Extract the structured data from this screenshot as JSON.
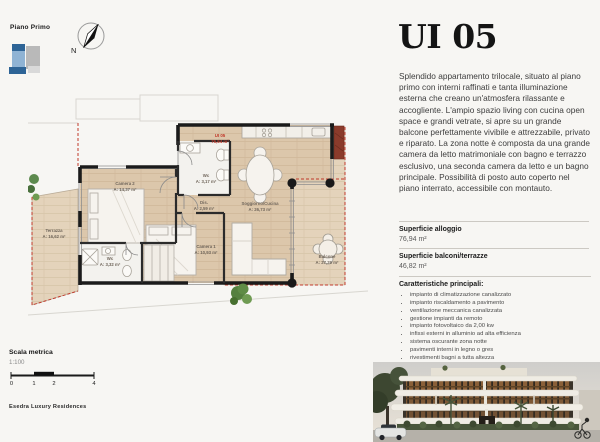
{
  "header": {
    "floor_label": "Piano Primo"
  },
  "compass": {
    "label": "N"
  },
  "unit": {
    "title": "UI 05",
    "description": "Splendido appartamento trilocale, situato al piano primo con interni raffinati e tanta illuminazione esterna che creano un'atmosfera rilassante e accogliente. L'ampio spazio living con cucina open space e grandi vetrate, si apre su un grande balcone perfettamente vivibile e attrezzabile, privato e riparato. La zona notte è composta da una grande camera da letto matrimoniale con bagno e terrazzo esclusivo, una seconda camera da letto e un bagno principale. Possibilità di posto auto coperto nel piano interrato, accessibile con montauto."
  },
  "surfaces": [
    {
      "label": "Superficie alloggio",
      "value": "76,94 m²"
    },
    {
      "label": "Superficie balconi/terrazze",
      "value": "46,82 m²"
    }
  ],
  "features": {
    "heading": "Caratteristiche principali:",
    "items": [
      "impianto di climatizzazione canalizzato",
      "impianto riscaldamento a pavimento",
      "ventilazione meccanica canalizzata",
      "gestione impianti da remoto",
      "impianto fotovoltaico da 2,00 kw",
      "infissi esterni in alluminio ad alta efficienza",
      "sistema oscurante zona notte",
      "pavimenti interni in legno o gres",
      "rivestimenti bagni a tutta altezza",
      "sanitari e rubinetterie di pregio"
    ]
  },
  "rooms": [
    {
      "name": "Terrazza",
      "area": "A: 16,62 m²"
    },
    {
      "name": "Camera 2",
      "area": "A: 14,37 m²"
    },
    {
      "name": "Wc",
      "area": "A: 3,17 m²"
    },
    {
      "name": "Dis.",
      "area": "A: 2,59 m²"
    },
    {
      "name": "Soggiorno/Cucina",
      "area": "A: 26,73 m²"
    },
    {
      "name": "Camera 1",
      "area": "A: 10,93 m²"
    },
    {
      "name": "Wc",
      "area": "A: 3,32 m²"
    },
    {
      "name": "Balcone",
      "area": "A: 27,29 m²"
    }
  ],
  "unit_tag": {
    "line1": "UI 05",
    "line2": "76,94 m²"
  },
  "scale": {
    "heading": "Scala metrica",
    "ratio": "1:100",
    "ticks": [
      "0",
      "1",
      "2",
      "4"
    ]
  },
  "brand": "Esedra Luxury Residences",
  "colors": {
    "wood": "#dcc7ab",
    "wood_outdoor": "#e4d3bb",
    "wall": "#1b1b1b",
    "boundary_red": "#c0392b",
    "feature_red": "#8b3b2b",
    "icon_blue_dark": "#2e6496",
    "icon_blue_light": "#8fb3d4",
    "icon_gray": "#b9b9b9"
  }
}
